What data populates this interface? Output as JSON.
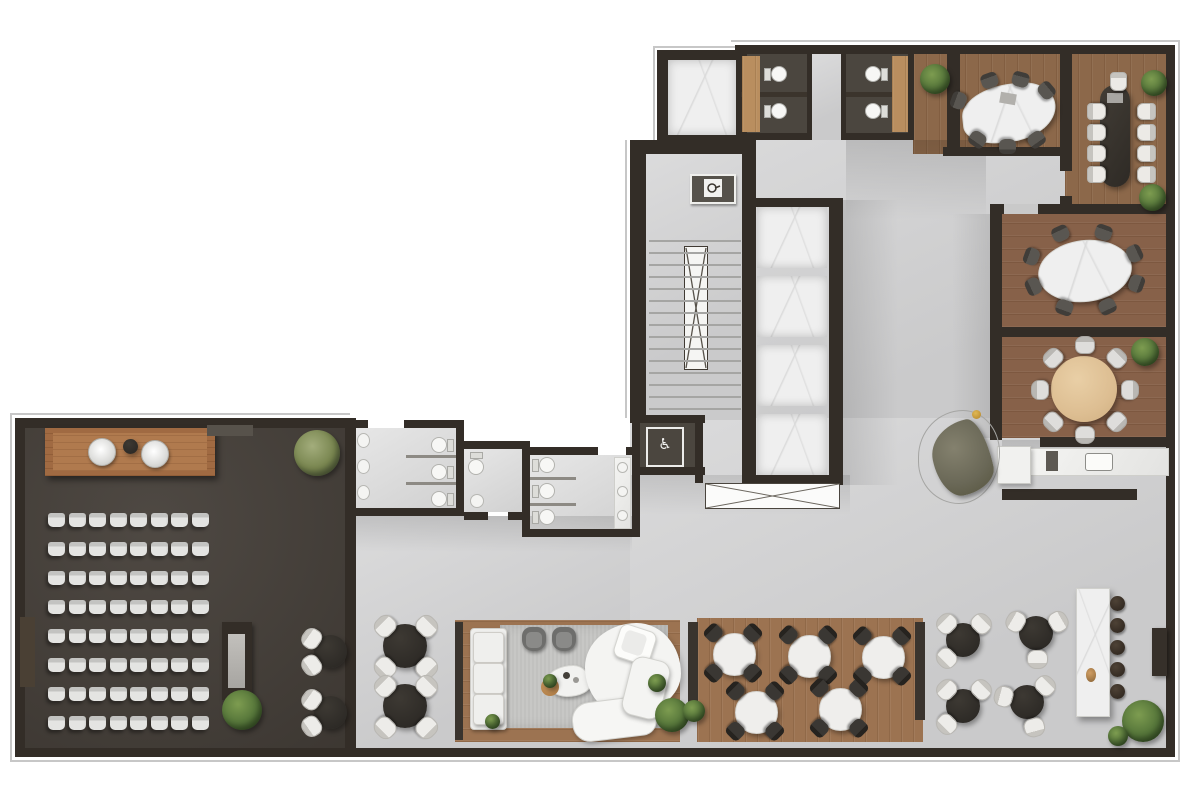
{
  "meta": {
    "drawing_type": "architectural floor plan, rendered top-down view",
    "level_use": "office amenity floor",
    "canvas": {
      "width": 1200,
      "height": 800
    }
  },
  "palette": {
    "background": "#ffffff",
    "wall": "#332d27",
    "concrete_floor": "#d3d3d4",
    "wood_floor": "#8c684a",
    "wood_floor_light": "#9c7351",
    "oak_table": "#ddbe92",
    "auditorium_floor": "#453f39",
    "stall_floor": "#4b463f",
    "restroom_floor": "#dcdcdc",
    "marble": "#efefef",
    "dark_furniture": "#332f2b",
    "white_furniture": "#eceae6",
    "plant_green": "#547439",
    "olive_sofa": "#6f6d5c",
    "accent_gold": "#c59a36",
    "rug_gray": "#c7c7c5"
  },
  "icons": {
    "wheelchair": "♿",
    "fire_hose_label": "fire-hose-cabinet"
  },
  "rooms": [
    {
      "id": "auditorium",
      "name": "Auditorium / town-hall room",
      "seats": 64,
      "stage_chairs": 2,
      "bistro_tables": 2,
      "plants": 2
    },
    {
      "id": "stairwell",
      "name": "Stair core",
      "flights": 2
    },
    {
      "id": "elevator-bank",
      "name": "Elevator bank",
      "cabs": 4
    },
    {
      "id": "service-elevator",
      "name": "Service elevator",
      "cabs": 1
    },
    {
      "id": "north-stalls",
      "name": "North toilet stalls",
      "toilets": 4
    },
    {
      "id": "meeting-room-1",
      "name": "Meeting room (organic marble table)",
      "chairs": 7
    },
    {
      "id": "boardroom",
      "name": "Boardroom (long dark table)",
      "chairs": 9
    },
    {
      "id": "meeting-room-oval",
      "name": "Meeting room (oval marble table)",
      "chairs": 8
    },
    {
      "id": "meeting-room-round",
      "name": "Meeting room (round oak table)",
      "chairs": 8
    },
    {
      "id": "kitchenette",
      "name": "Kitchenette / pantry",
      "sinks": 1
    },
    {
      "id": "restroom-a",
      "name": "Restroom A",
      "toilets": 3,
      "sinks": 3
    },
    {
      "id": "single-wc",
      "name": "Single WC",
      "toilets": 1,
      "sinks": 1
    },
    {
      "id": "restroom-b",
      "name": "Restroom B",
      "toilets": 3,
      "sinks": 3
    },
    {
      "id": "accessible-wc",
      "name": "Accessible WC",
      "toilets": 0,
      "icon": "wheelchair"
    },
    {
      "id": "lounge",
      "name": "Lounge",
      "sofas": 2,
      "armchairs": 2,
      "coffee_tables": 1
    },
    {
      "id": "dining",
      "name": "Dining area",
      "tables": 5,
      "chairs_per_table": 4
    },
    {
      "id": "cafe",
      "name": "Café area",
      "tables": 4,
      "chairs_per_table": 3
    },
    {
      "id": "bar",
      "name": "Bar counter",
      "stools": 5
    },
    {
      "id": "hall-tables",
      "name": "Open-hall tables",
      "tables": 2,
      "chairs_per_table": 4
    }
  ],
  "generated": {
    "auditorium_seats": {
      "rows": 8,
      "cols": 8,
      "x": 48,
      "y": 513,
      "w": 17,
      "h": 14,
      "gap_x": 3.5,
      "gap_y": 15
    },
    "elevator_bank": {
      "count": 4,
      "x": 757,
      "y": 207,
      "w": 70,
      "h": 61,
      "gap": 8
    },
    "stair_treads": {
      "count": 15,
      "x": 649,
      "y": 240,
      "w": 92,
      "step": 12
    },
    "bar_stools": {
      "count": 5,
      "cx": 1117,
      "y0": 603,
      "dy": 22,
      "d": 15
    },
    "table_sets": [
      {
        "name": "dining-table-1",
        "cx": 733,
        "cy": 653,
        "table": {
          "cls": "tbl-white",
          "w": 41,
          "h": 41
        },
        "chairs": {
          "cls": "ch-black",
          "w": 17,
          "h": 16,
          "dist": 28,
          "angles": [
            45,
            135,
            225,
            315
          ]
        }
      },
      {
        "name": "dining-table-2",
        "cx": 808,
        "cy": 655,
        "table": {
          "cls": "tbl-white",
          "w": 41,
          "h": 41
        },
        "chairs": {
          "cls": "ch-black",
          "w": 17,
          "h": 16,
          "dist": 28,
          "angles": [
            45,
            135,
            225,
            315
          ]
        }
      },
      {
        "name": "dining-table-3",
        "cx": 882,
        "cy": 656,
        "table": {
          "cls": "tbl-white",
          "w": 41,
          "h": 41
        },
        "chairs": {
          "cls": "ch-black",
          "w": 17,
          "h": 16,
          "dist": 28,
          "angles": [
            45,
            135,
            225,
            315
          ]
        }
      },
      {
        "name": "dining-table-4",
        "cx": 755,
        "cy": 711,
        "table": {
          "cls": "tbl-white",
          "w": 41,
          "h": 41
        },
        "chairs": {
          "cls": "ch-black",
          "w": 17,
          "h": 16,
          "dist": 28,
          "angles": [
            45,
            135,
            225,
            315
          ]
        }
      },
      {
        "name": "dining-table-5",
        "cx": 839,
        "cy": 708,
        "table": {
          "cls": "tbl-white",
          "w": 41,
          "h": 41
        },
        "chairs": {
          "cls": "ch-black",
          "w": 17,
          "h": 16,
          "dist": 28,
          "angles": [
            45,
            135,
            225,
            315
          ]
        }
      },
      {
        "name": "cafe-table-1",
        "cx": 963,
        "cy": 640,
        "table": {
          "cls": "tbl-dark",
          "w": 34,
          "h": 34
        },
        "chairs": {
          "cls": "ch-white",
          "w": 19,
          "h": 17,
          "dist": 25,
          "angles": [
            135,
            225,
            315
          ]
        }
      },
      {
        "name": "cafe-table-2",
        "cx": 1036,
        "cy": 633,
        "table": {
          "cls": "tbl-dark",
          "w": 34,
          "h": 34
        },
        "chairs": {
          "cls": "ch-white",
          "w": 19,
          "h": 17,
          "dist": 25,
          "angles": [
            90,
            210,
            330
          ]
        }
      },
      {
        "name": "cafe-table-3",
        "cx": 963,
        "cy": 706,
        "table": {
          "cls": "tbl-dark",
          "w": 34,
          "h": 34
        },
        "chairs": {
          "cls": "ch-white",
          "w": 19,
          "h": 17,
          "dist": 25,
          "angles": [
            135,
            225,
            315
          ]
        }
      },
      {
        "name": "cafe-table-4",
        "cx": 1027,
        "cy": 702,
        "table": {
          "cls": "tbl-dark",
          "w": 34,
          "h": 34
        },
        "chairs": {
          "cls": "ch-white",
          "w": 19,
          "h": 17,
          "dist": 25,
          "angles": [
            75,
            195,
            315
          ]
        }
      },
      {
        "name": "hall-table-1",
        "cx": 405,
        "cy": 646,
        "table": {
          "cls": "tbl-dark",
          "w": 44,
          "h": 44
        },
        "chairs": {
          "cls": "ch-white",
          "w": 20,
          "h": 18,
          "dist": 30,
          "angles": [
            45,
            135,
            225,
            315
          ]
        }
      },
      {
        "name": "hall-table-2",
        "cx": 405,
        "cy": 706,
        "table": {
          "cls": "tbl-dark",
          "w": 44,
          "h": 44
        },
        "chairs": {
          "cls": "ch-white",
          "w": 20,
          "h": 18,
          "dist": 30,
          "angles": [
            45,
            135,
            225,
            315
          ]
        }
      },
      {
        "name": "auditorium-bistro-1",
        "cx": 330,
        "cy": 651,
        "table": {
          "cls": "tbl-dark",
          "w": 33,
          "h": 33
        },
        "chairs": {
          "cls": "ch-white",
          "w": 19,
          "h": 17,
          "dist": 24,
          "angles": [
            145,
            215
          ]
        }
      },
      {
        "name": "auditorium-bistro-2",
        "cx": 330,
        "cy": 712,
        "table": {
          "cls": "tbl-dark",
          "w": 33,
          "h": 33
        },
        "chairs": {
          "cls": "ch-white",
          "w": 19,
          "h": 17,
          "dist": 24,
          "angles": [
            145,
            215
          ]
        }
      },
      {
        "name": "meeting-room-1",
        "cx": 1007,
        "cy": 112,
        "table": null,
        "chairs": {
          "cls": "ch-dark",
          "w": 17,
          "h": 15,
          "rx": 52,
          "ry": 34,
          "angles": [
            250,
            285,
            320,
            200,
            55,
            90,
            125
          ]
        }
      },
      {
        "name": "meeting-room-oval",
        "cx": 1084,
        "cy": 270,
        "table": null,
        "chairs": {
          "cls": "ch-dark",
          "w": 17,
          "h": 15,
          "rx": 56,
          "ry": 40,
          "angles": [
            245,
            290,
            335,
            200,
            20,
            65,
            110,
            155
          ]
        }
      },
      {
        "name": "meeting-room-round",
        "cx": 1084,
        "cy": 389,
        "table": null,
        "chairs": {
          "cls": "ch-light",
          "w": 18,
          "h": 16,
          "dist": 45,
          "count": 8,
          "start": 270
        }
      }
    ],
    "chair_rows": [
      {
        "name": "boardroom-chair",
        "cls": "ch-side",
        "w": 15,
        "h": 17,
        "points": [
          [
            1095,
            110,
            -90
          ],
          [
            1095,
            131,
            -90
          ],
          [
            1095,
            152,
            -90
          ],
          [
            1095,
            173,
            -90
          ],
          [
            1145,
            110,
            90
          ],
          [
            1145,
            131,
            90
          ],
          [
            1145,
            152,
            90
          ],
          [
            1145,
            173,
            90
          ],
          [
            1117,
            80,
            0
          ]
        ]
      }
    ]
  }
}
